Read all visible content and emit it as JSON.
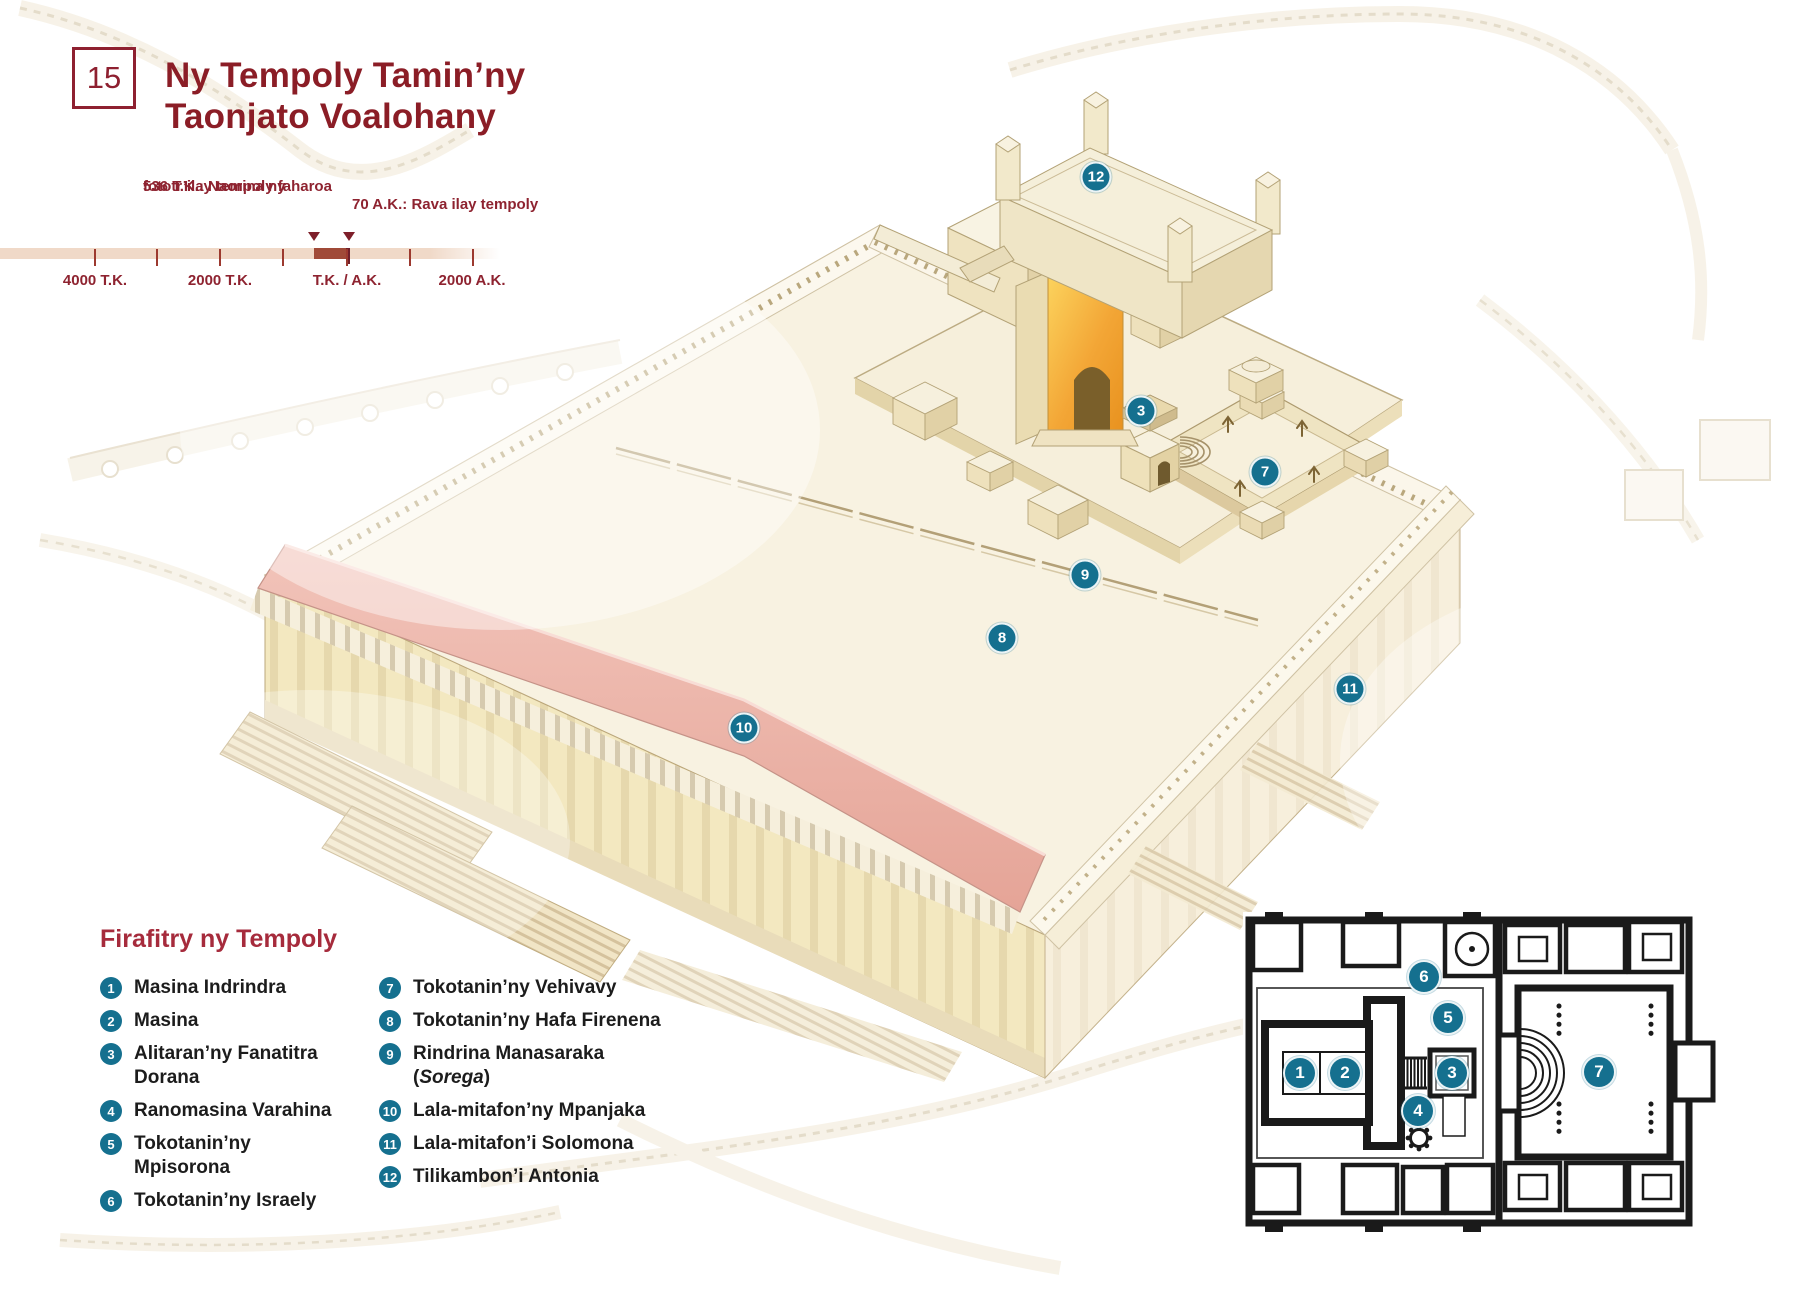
{
  "header": {
    "number": "15",
    "title_line1": "Ny Tempoly Tamin’ny",
    "title_line2": "Taonjato Voalohany"
  },
  "timeline": {
    "event1_line1": "536 T.K.: Naorina ny",
    "event1_line2": "fototr’ilay tempoly faharoa",
    "event2": "70 A.K.: Rava ilay tempoly",
    "arrows": [
      {
        "x": 314
      },
      {
        "x": 349
      }
    ],
    "tick_lines": [
      {
        "x": 95
      },
      {
        "x": 157
      },
      {
        "x": 220
      },
      {
        "x": 283
      },
      {
        "x": 347
      },
      {
        "x": 410
      },
      {
        "x": 473
      }
    ],
    "tick_labels": [
      {
        "label": "4000 T.K.",
        "x": 95
      },
      {
        "label": "2000 T.K.",
        "x": 220
      },
      {
        "label": "T.K. / A.K.",
        "x": 347
      },
      {
        "label": "2000 A.K.",
        "x": 472
      }
    ]
  },
  "legend": {
    "title": "Firafitry ny Tempoly",
    "col1": [
      {
        "n": "1",
        "pre": "Masina Indrindra"
      },
      {
        "n": "2",
        "pre": "Masina"
      },
      {
        "n": "3",
        "pre": "Alitaran’ny Fanatitra Dorana"
      },
      {
        "n": "4",
        "pre": "Ranomasina Varahina"
      },
      {
        "n": "5",
        "pre": "Tokotanin’ny Mpisorona"
      },
      {
        "n": "6",
        "pre": "Tokotanin’ny Israely"
      }
    ],
    "col2": [
      {
        "n": "7",
        "pre": "Tokotanin’ny Vehivavy"
      },
      {
        "n": "8",
        "pre": "Tokotanin’ny Hafa Firenena"
      },
      {
        "n": "9",
        "pre": "Rindrina Manasaraka (",
        "italic": "Sorega",
        "post": ")"
      },
      {
        "n": "10",
        "pre": "Lala-mitafon’ny Mpanjaka"
      },
      {
        "n": "11",
        "pre": "Lala-mitafon’i Solomona"
      },
      {
        "n": "12",
        "pre": "Tilikambon’i Antonia"
      }
    ]
  },
  "illustration": {
    "markers": [
      {
        "n": "3",
        "x": 1141,
        "y": 411
      },
      {
        "n": "7",
        "x": 1265,
        "y": 472
      },
      {
        "n": "8",
        "x": 1002,
        "y": 638
      },
      {
        "n": "9",
        "x": 1085,
        "y": 575
      },
      {
        "n": "10",
        "x": 744,
        "y": 728
      },
      {
        "n": "11",
        "x": 1350,
        "y": 689
      },
      {
        "n": "12",
        "x": 1096,
        "y": 177
      }
    ]
  },
  "plan": {
    "markers": [
      {
        "n": "1",
        "x": 57,
        "y": 161
      },
      {
        "n": "2",
        "x": 102,
        "y": 161
      },
      {
        "n": "3",
        "x": 209,
        "y": 161
      },
      {
        "n": "4",
        "x": 175,
        "y": 199
      },
      {
        "n": "5",
        "x": 205,
        "y": 106
      },
      {
        "n": "6",
        "x": 181,
        "y": 65
      },
      {
        "n": "7",
        "x": 356,
        "y": 160
      }
    ]
  },
  "colors": {
    "accent_maroon": "#8e2030",
    "legend_red": "#a62b3c",
    "marker_teal": "#15708f",
    "timeline_bar": "#f0d9c8",
    "timeline_highlight": "#a04a38",
    "roof_pink": "#ecb3a8",
    "facade_gold": "#f5b43c"
  }
}
